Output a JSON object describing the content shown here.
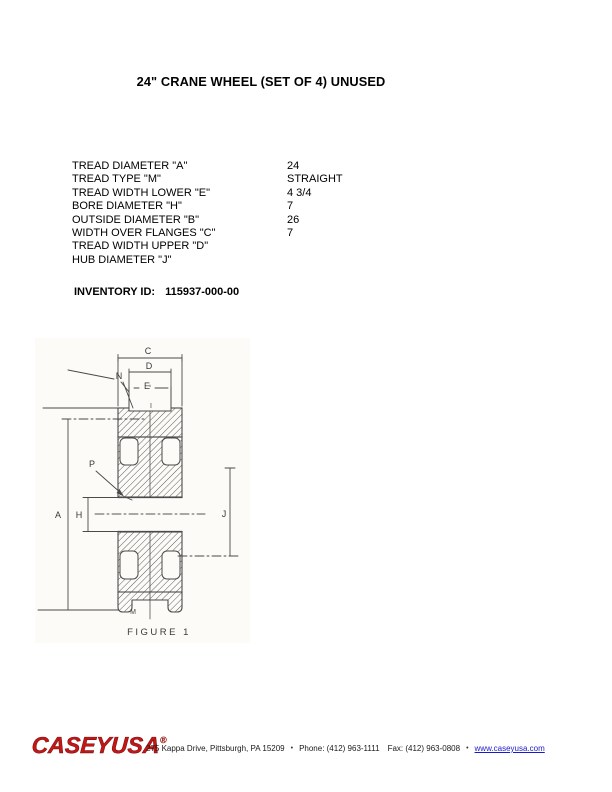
{
  "title": "24\" CRANE WHEEL (SET OF 4) UNUSED",
  "specs": {
    "rows": [
      {
        "label": "TREAD DIAMETER \"A\"",
        "value": "24"
      },
      {
        "label": "TREAD TYPE \"M\"",
        "value": "STRAIGHT"
      },
      {
        "label": "TREAD WIDTH LOWER \"E\"",
        "value": "4 3/4"
      },
      {
        "label": "BORE DIAMETER \"H\"",
        "value": "7"
      },
      {
        "label": "OUTSIDE DIAMETER \"B\"",
        "value": "26"
      },
      {
        "label": "WIDTH OVER FLANGES \"C\"",
        "value": "7"
      },
      {
        "label": "TREAD WIDTH UPPER \"D\"",
        "value": ""
      },
      {
        "label": "HUB DIAMETER \"J\"",
        "value": ""
      }
    ]
  },
  "inventory": {
    "label": "INVENTORY ID:",
    "value": "115937-000-00"
  },
  "figure": {
    "caption": "FIGURE 1",
    "labels": {
      "c": "C",
      "d": "D",
      "e": "E",
      "n": "N",
      "i": "I",
      "p": "P",
      "a": "A",
      "h": "H",
      "j": "J",
      "m": "M"
    }
  },
  "footer": {
    "logo": "CASEYUSA",
    "registered": "®",
    "address": "275 Kappa Drive, Pittsburgh, PA  15209",
    "phone": "Phone: (412) 963-1111",
    "fax": "Fax: (412) 963-0808",
    "website": "www.caseyusa.com",
    "separator": "•",
    "logo_color": "#c41616",
    "link_color": "#1a1acc"
  }
}
